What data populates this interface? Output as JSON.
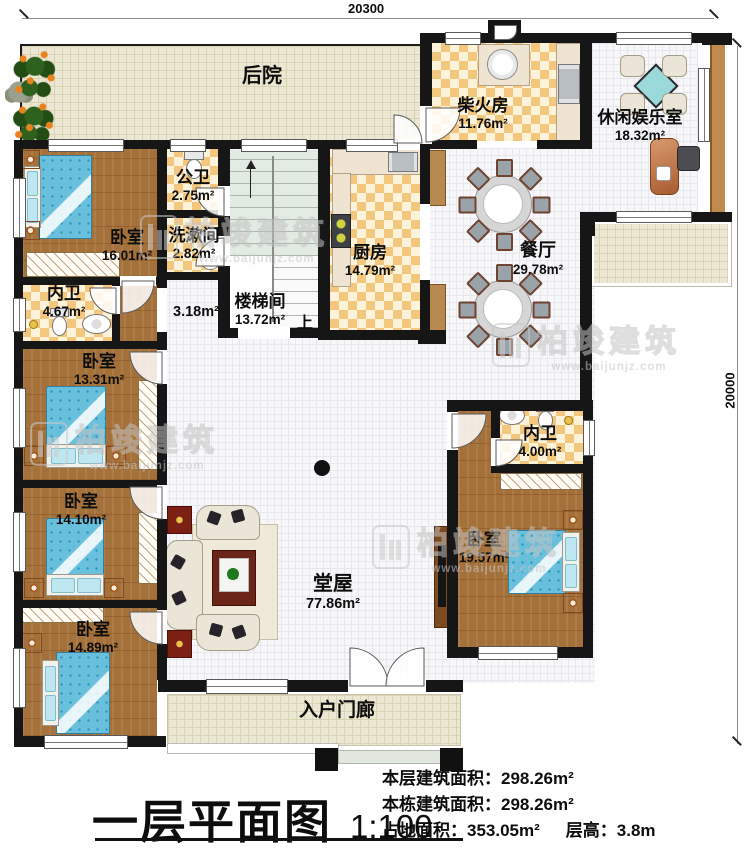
{
  "dimensions": {
    "top": "20300",
    "right": "20000"
  },
  "rooms": {
    "backyard": {
      "name": "后院"
    },
    "firewood": {
      "name": "柴火房",
      "area": "11.76m²"
    },
    "leisure": {
      "name": "休闲娱乐室",
      "area": "18.32m²"
    },
    "public_bath": {
      "name": "公卫",
      "area": "2.75m²"
    },
    "washroom": {
      "name": "洗漱间",
      "area": "2.82m²"
    },
    "bedroom1": {
      "name": "卧室",
      "area": "16.01m²"
    },
    "ensuite1": {
      "name": "内卫",
      "area": "4.67m²"
    },
    "kitchen": {
      "name": "厨房",
      "area": "14.79m²"
    },
    "stairwell": {
      "name": "楼梯间",
      "area": "13.72m²",
      "up": "上"
    },
    "hallway": {
      "area": "3.18m²"
    },
    "dining": {
      "name": "餐厅",
      "area": "29.78m²"
    },
    "bedroom2": {
      "name": "卧室",
      "area": "13.31m²"
    },
    "ensuite2": {
      "name": "内卫",
      "area": "4.00m²"
    },
    "bedroom3": {
      "name": "卧室",
      "area": "14.10m²"
    },
    "bedroom4": {
      "name": "卧室",
      "area": "19.57m²"
    },
    "bedroom5": {
      "name": "卧室",
      "area": "14.89m²"
    },
    "living": {
      "name": "堂屋",
      "area": "77.86m²"
    },
    "porch": {
      "name": "入户门廊"
    }
  },
  "footer": {
    "title": "一层平面图",
    "scale": "1:100",
    "stats": [
      {
        "label": "本层建筑面积：",
        "value": "298.26m²"
      },
      {
        "label": "本栋建筑面积：",
        "value": "298.26m²"
      },
      {
        "label": "占地面积：",
        "value": "353.05m²"
      },
      {
        "label": "层高：",
        "value": "3.8m"
      }
    ]
  },
  "watermark": {
    "brand": "柏竣建筑",
    "url": "www.baijunjz.com"
  }
}
